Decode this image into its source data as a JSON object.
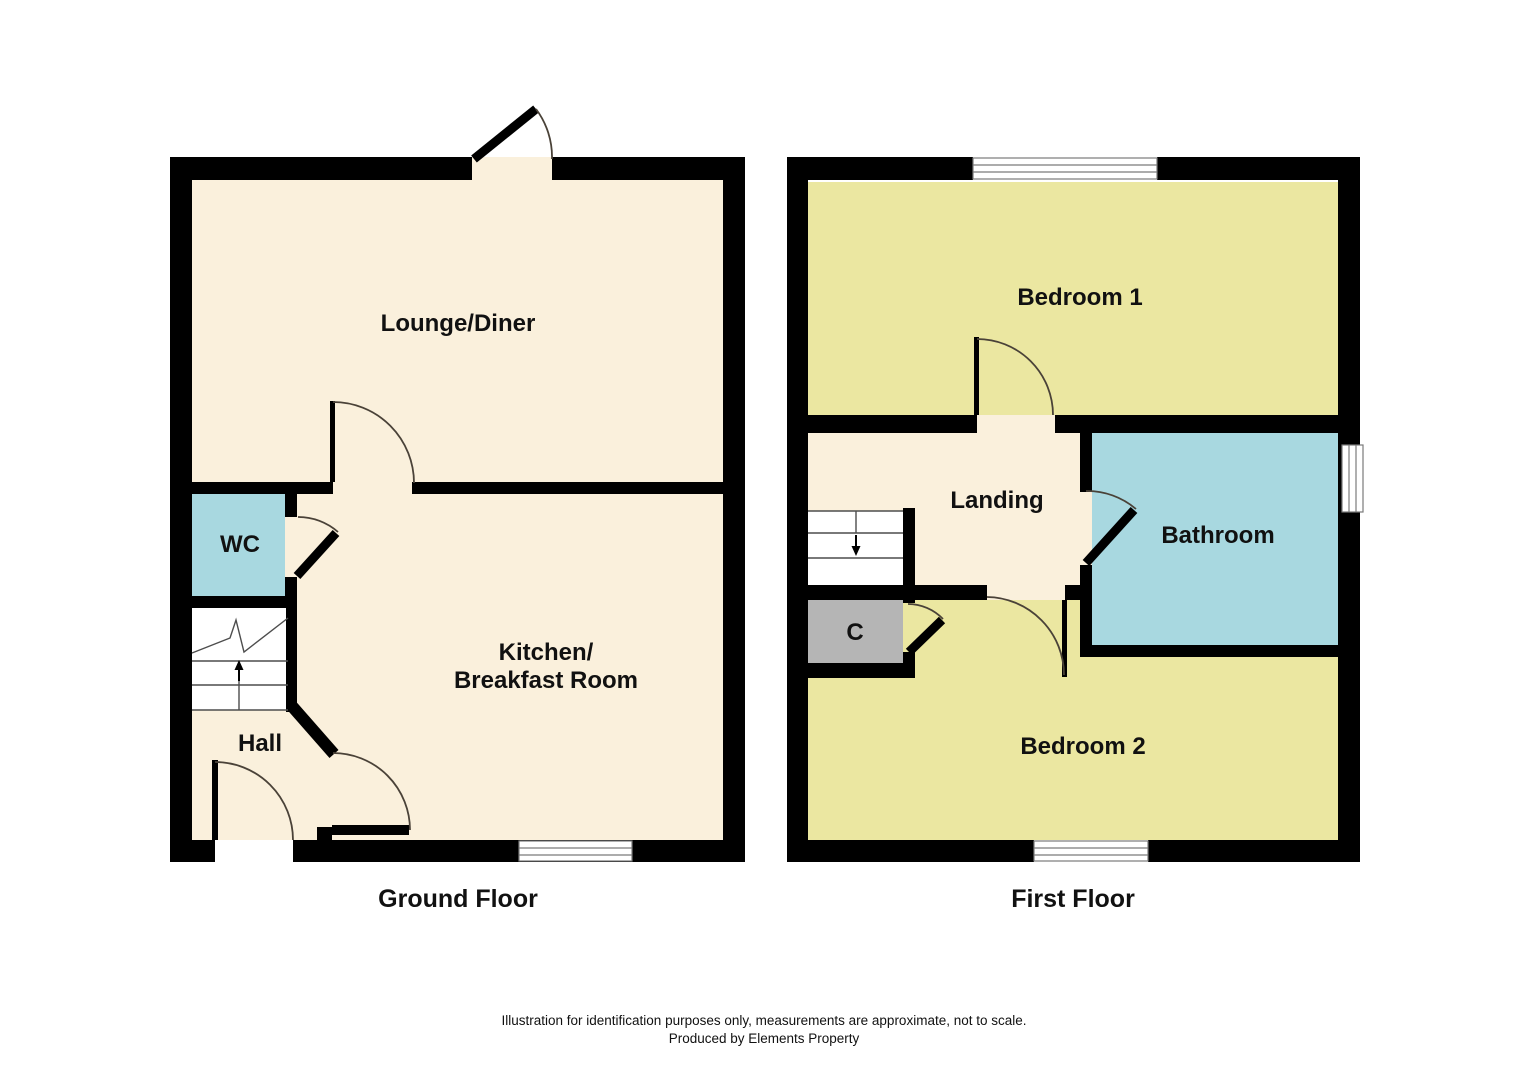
{
  "floors": {
    "ground": {
      "title": "Ground Floor",
      "rooms": {
        "lounge": "Lounge/Diner",
        "wc": "WC",
        "kitchen_line1": "Kitchen/",
        "kitchen_line2": "Breakfast Room",
        "hall": "Hall"
      }
    },
    "first": {
      "title": "First Floor",
      "rooms": {
        "bedroom1": "Bedroom 1",
        "landing": "Landing",
        "bathroom": "Bathroom",
        "cupboard": "C",
        "bedroom2": "Bedroom 2"
      }
    }
  },
  "footer": {
    "line1": "Illustration for identification purposes only, measurements are approximate, not to scale.",
    "line2": "Produced by Elements Property"
  },
  "colors": {
    "wall": "#000000",
    "room-cream": "#faf0dc",
    "room-yellow": "#ebe7a1",
    "room-cyan": "#a8d8e0",
    "room-gray": "#b5b5b5",
    "stairs-white": "#ffffff",
    "arc": "#4a4238",
    "detail-line": "#4d4d4d",
    "window-line": "#7a7a7a",
    "text": "#111111",
    "background": "#ffffff"
  }
}
